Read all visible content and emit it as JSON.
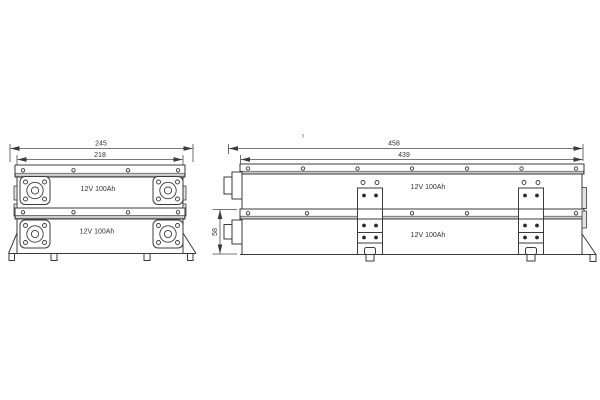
{
  "meta": {
    "background": "#ffffff",
    "line_color": "#3b3b3b",
    "rail_shade_color": "#cccccc"
  },
  "front_view": {
    "dim_overall_width": "245",
    "dim_body_width": "218",
    "units": [
      {
        "label": "12V 100Ah"
      },
      {
        "label": "12V 100Ah"
      }
    ]
  },
  "side_view": {
    "dim_overall_length": "458",
    "dim_body_length": "439",
    "dim_unit_height": "58",
    "units": [
      {
        "label": "12V 100Ah"
      },
      {
        "label": "12V 100Ah"
      }
    ]
  }
}
